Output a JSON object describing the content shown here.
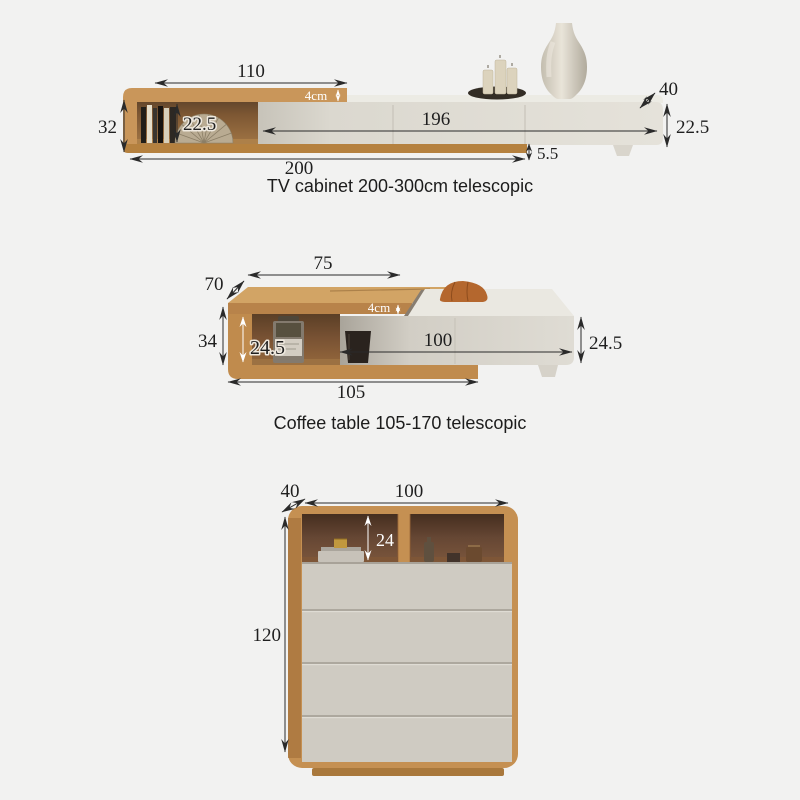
{
  "figures": {
    "tv_cabinet": {
      "caption": "TV cabinet 200-300cm telescopic",
      "dims": {
        "top_width": "110",
        "panel_thickness": "4cm",
        "depth": "40",
        "left_height": "32",
        "shelf_height": "22.5",
        "unit_length": "196",
        "unit_height": "22.5",
        "base_gap": "5.5",
        "base_length": "200"
      }
    },
    "coffee_table": {
      "caption": "Coffee table 105-170 telescopic",
      "dims": {
        "top_width": "75",
        "depth": "70",
        "panel_thickness": "4cm",
        "left_height": "34",
        "shelf_height": "24.5",
        "unit_length": "100",
        "unit_height": "24.5",
        "base_length": "105"
      }
    },
    "chest": {
      "dims": {
        "depth": "40",
        "width": "100",
        "shelf_height": "24",
        "height": "120"
      }
    }
  },
  "colors": {
    "background": "#f2f2f1",
    "wood": "#c28c4e",
    "wood_light": "#d2a465",
    "unit_front": "#e1ded6",
    "interior_dark": "#6a4a30",
    "dimension_ink": "#2a2a2a"
  }
}
